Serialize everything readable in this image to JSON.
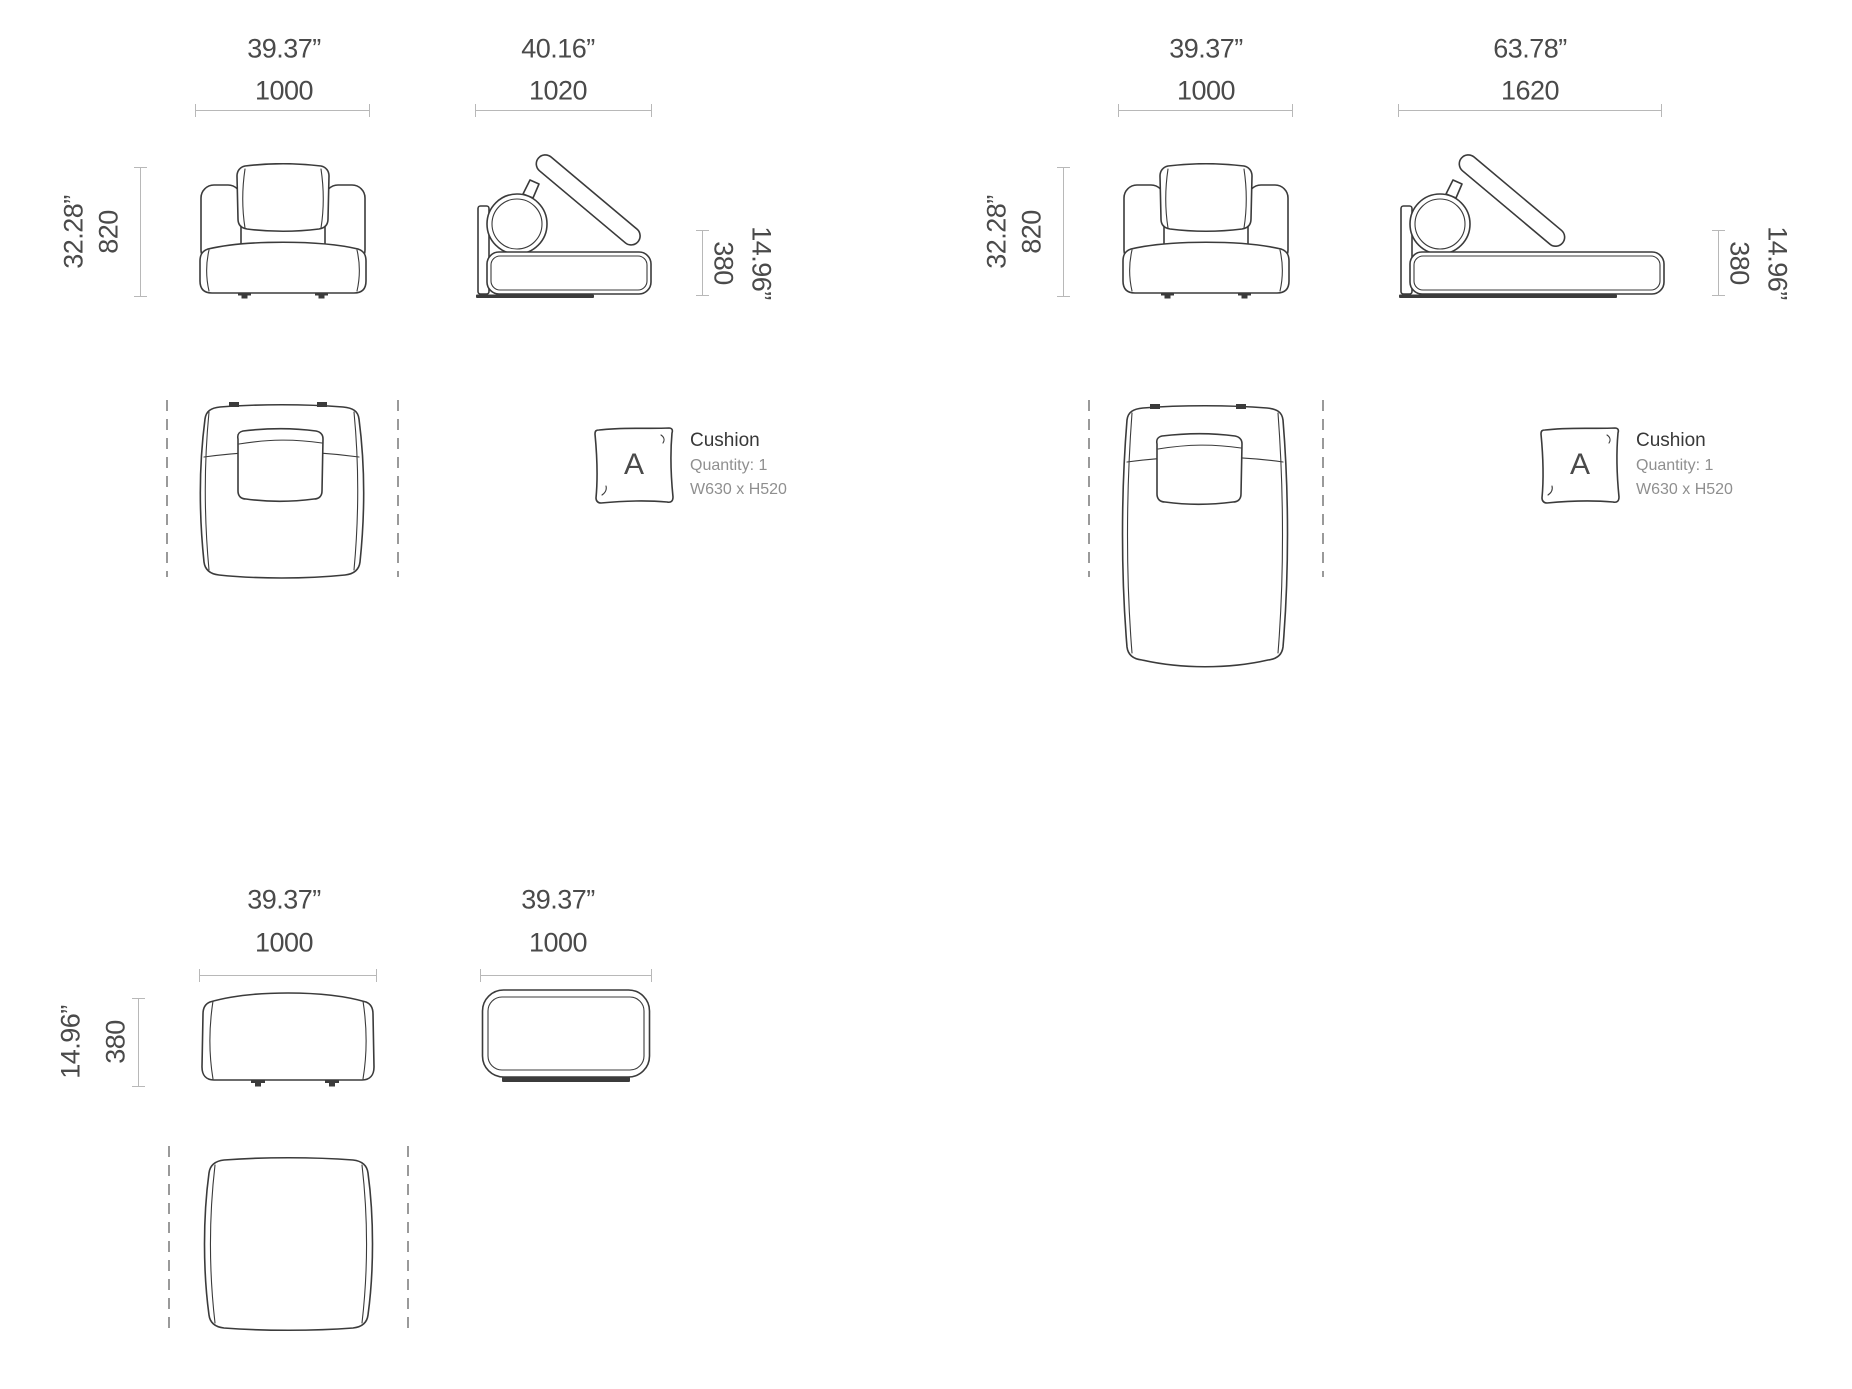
{
  "colors": {
    "background": "#ffffff",
    "drawing_stroke": "#3b3b3b",
    "dimension_line": "#b8b8b8",
    "dimension_text": "#4a4a4a",
    "muted_text": "#8f8f8f",
    "dashed_guide": "#9a9a9a"
  },
  "groups": {
    "module": {
      "front_width": {
        "inches": "39.37”",
        "mm": "1000"
      },
      "depth": {
        "inches": "40.16”",
        "mm": "1020"
      },
      "height": {
        "inches": "32.28”",
        "mm": "820"
      },
      "seat_height": {
        "inches": "14.96”",
        "mm": "380"
      },
      "cushion": {
        "letter": "A",
        "title": "Cushion",
        "quantity": "Quantity: 1",
        "size": "W630 x H520"
      }
    },
    "chaise": {
      "front_width": {
        "inches": "39.37”",
        "mm": "1000"
      },
      "depth": {
        "inches": "63.78”",
        "mm": "1620"
      },
      "height": {
        "inches": "32.28”",
        "mm": "820"
      },
      "seat_height": {
        "inches": "14.96”",
        "mm": "380"
      },
      "cushion": {
        "letter": "A",
        "title": "Cushion",
        "quantity": "Quantity: 1",
        "size": "W630 x H520"
      }
    },
    "ottoman": {
      "front_width": {
        "inches": "39.37”",
        "mm": "1000"
      },
      "depth": {
        "inches": "39.37”",
        "mm": "1000"
      },
      "height": {
        "inches": "14.96”",
        "mm": "380"
      }
    }
  }
}
